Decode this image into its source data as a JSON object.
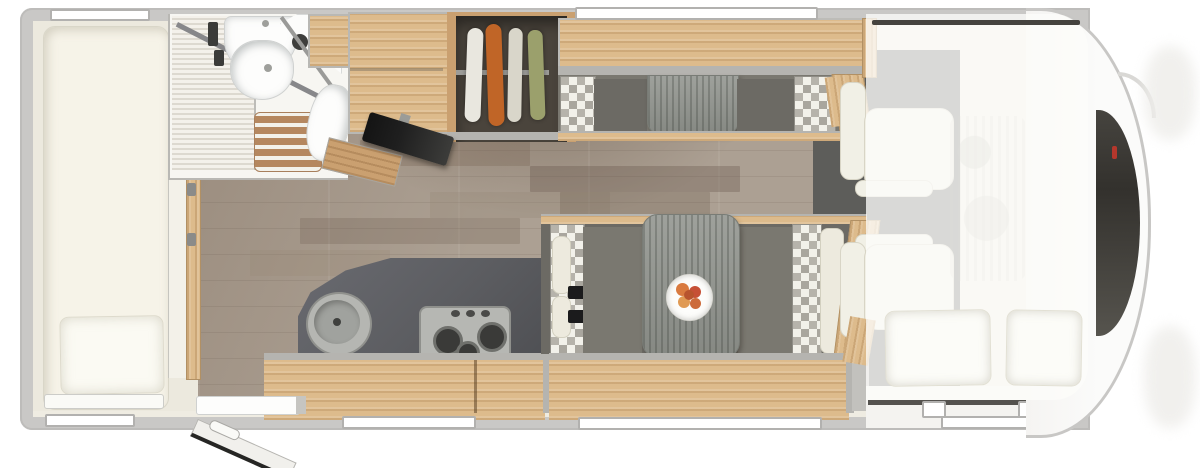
{
  "title": "Motorhome floor plan - top view",
  "colors": {
    "body_wall": "#c9c8c6",
    "interior_trim": "#efece2",
    "wood": "#ddbb8c",
    "wood_dark": "#caa070",
    "floor_light": "#aca093",
    "counter": "#5c5d61",
    "cushion": "#7a7870",
    "cushion_dark": "#6c6a64",
    "table_wood": "#91948e",
    "cream_pad": "#edeade",
    "dark_floor": "#5d5d5a",
    "wardrobe_interior": "#4a443c",
    "mattress": "#f6f3e8",
    "tv": "#1f1f1f",
    "windshield_dark": "#33312d",
    "garment1": "#e9e7df",
    "garment2": "#c06527",
    "garment3": "#d9d6ca",
    "garment4": "#9ba06c"
  },
  "areas": {
    "rear_bed": {
      "fixtures": [
        "mattress",
        "pillow",
        "entry-step"
      ],
      "windows": 2
    },
    "bathroom": {
      "fixtures": [
        "folding-door",
        "shower-glass",
        "washbasin",
        "corner-shelf",
        "shower-grate",
        "toilet"
      ]
    },
    "wardrobe": {
      "garments": 4,
      "fixtures": [
        "hanger-rail"
      ]
    },
    "media": {
      "fixtures": [
        "tv-on-swivel-arm",
        "sideboard"
      ]
    },
    "kitchen": {
      "fixtures": [
        "countertop",
        "round-sink",
        "hob-3-burner",
        "base-cabinet"
      ]
    },
    "rear_dinette": {
      "fixtures": [
        "bench-pair-facing",
        "table",
        "overhead-locker",
        "checkered-cushions"
      ]
    },
    "front_dinette": {
      "fixtures": [
        "bench-pair-facing",
        "table",
        "plate-of-fruit",
        "seat-belts",
        "checkered-cushions",
        "headrests"
      ]
    },
    "cab": {
      "fixtures": [
        "driver-swivel-seat",
        "passenger-swivel-seat",
        "drop-down-bed-overlay",
        "pillow-left",
        "pillow-right",
        "windshield",
        "cab-door",
        "entry-step"
      ]
    }
  },
  "windows": {
    "top_wall": 2,
    "bottom_wall": 3,
    "cab_step_strips": 1
  },
  "door": {
    "state": "open",
    "location": "bottom-left"
  }
}
